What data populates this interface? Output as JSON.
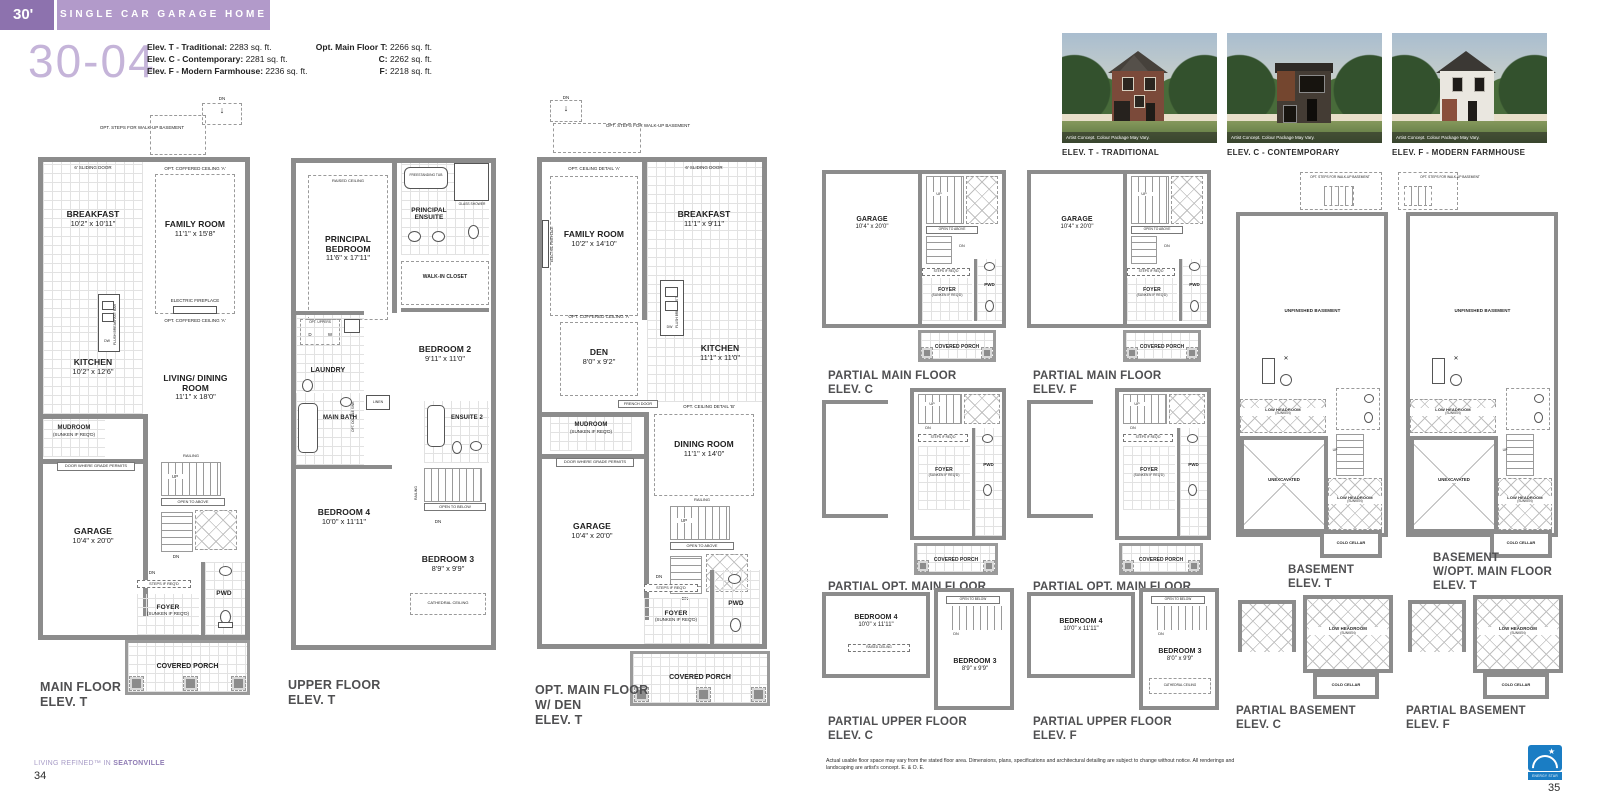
{
  "header": {
    "width_tag": "30'",
    "band": "SINGLE CAR GARAGE HOME",
    "model": "30-04",
    "specs": [
      {
        "label": "Elev. T - Traditional:",
        "value": " 2283 sq. ft."
      },
      {
        "label": "Elev. C - Contemporary:",
        "value": " 2281 sq. ft."
      },
      {
        "label": "Elev. F - Modern Farmhouse:",
        "value": " 2236 sq. ft."
      }
    ],
    "opt_specs": [
      {
        "label": "Opt. Main Floor T:",
        "value": " 2266 sq. ft."
      },
      {
        "label": "C:",
        "value": " 2262 sq. ft."
      },
      {
        "label": "F:",
        "value": " 2218 sq. ft."
      }
    ]
  },
  "elevations": {
    "caption": "Artist Concept. Colour Package May Vary.",
    "t": "ELEV. T - TRADITIONAL",
    "c": "ELEV. C - CONTEMPORARY",
    "f": "ELEV. F - MODERN FARMHOUSE"
  },
  "plan_main": {
    "title_l1": "MAIN FLOOR",
    "title_l2": "ELEV. T",
    "rooms": {
      "breakfast": {
        "name": "BREAKFAST",
        "dims": "10'2\" x 10'11\""
      },
      "family": {
        "name": "FAMILY ROOM",
        "dims": "11'1\" x 15'8\""
      },
      "kitchen": {
        "name": "KITCHEN",
        "dims": "10'2\" x 12'6\""
      },
      "mudroom": {
        "name": "MUDROOM",
        "sub": "(SUNKEN IF REQ'D)"
      },
      "living": {
        "name": "LIVING/ DINING ROOM",
        "dims": "11'1\" x 18'0\""
      },
      "garage": {
        "name": "GARAGE",
        "dims": "10'4\" x 20'0\""
      },
      "foyer": {
        "name": "FOYER",
        "sub": "(SUNKEN IF REQ'D)"
      },
      "pwd": {
        "name": "PWD"
      },
      "porch": {
        "name": "COVERED PORCH"
      }
    },
    "notes": {
      "dn": "DN",
      "arrow_down": "↓",
      "walkup": "OPT. STEPS FOR WALK-UP BASEMENT",
      "sliding": "6' SLIDING DOOR",
      "coffered1": "OPT. COFFERED CEILING 'A'",
      "fireplace": "ELECTRIC FIREPLACE",
      "coffered2": "OPT. COFFERED CEILING 'A'",
      "bkfstbar": "FLUSH BREAKFAST BAR",
      "dw": "DW",
      "gradedoor": "DOOR WHERE GRADE PERMITS",
      "railing": "RAILING",
      "up": "UP",
      "ota": "OPEN TO ABOVE",
      "dn2": "DN",
      "steps": "STEPS IF REQ'D"
    }
  },
  "plan_upper": {
    "title_l1": "UPPER FLOOR",
    "title_l2": "ELEV. T",
    "rooms": {
      "principal": {
        "name": "PRINCIPAL BEDROOM",
        "dims": "11'6\" x 17'11\""
      },
      "ensuite": {
        "name": "PRINCIPAL ENSUITE"
      },
      "wic": {
        "name": "WALK-IN CLOSET"
      },
      "bed2": {
        "name": "BEDROOM 2",
        "dims": "9'11\" x 11'0\""
      },
      "laundry": {
        "name": "LAUNDRY"
      },
      "mainbath": {
        "name": "MAIN BATH"
      },
      "bed4": {
        "name": "BEDROOM 4",
        "dims": "10'0\" x 11'11\""
      },
      "ensuite2": {
        "name": "ENSUITE 2"
      },
      "bed3": {
        "name": "BEDROOM 3",
        "dims": "8'9\" x 9'9\""
      }
    },
    "notes": {
      "raised": "RAISED CEILING",
      "tub": "FREESTANDING TUB",
      "shower": "GLASS SHOWER",
      "uppers": "OPT. UPPERS",
      "d": "D",
      "w": "W",
      "dblsink": "OPT. DOUBLE SINK",
      "linen": "LINEN",
      "railing": "RAILING",
      "otb": "OPEN TO BELOW",
      "dn": "DN",
      "cathedral": "CATHEDRAL CEILING"
    }
  },
  "plan_opt": {
    "title_l1": "OPT. MAIN FLOOR",
    "title_l2": "W/ DEN",
    "title_l3": "ELEV. T",
    "rooms": {
      "family": {
        "name": "FAMILY ROOM",
        "dims": "10'2\" x 14'10\""
      },
      "breakfast": {
        "name": "BREAKFAST",
        "dims": "11'1\" x 9'11\""
      },
      "kitchen": {
        "name": "KITCHEN",
        "dims": "11'1\" x 11'0\""
      },
      "den": {
        "name": "DEN",
        "dims": "8'0\" x 9'2\""
      },
      "mudroom": {
        "name": "MUDROOM",
        "sub": "(SUNKEN IF REQ'D)"
      },
      "dining": {
        "name": "DINING ROOM",
        "dims": "11'1\" x 14'0\""
      },
      "garage": {
        "name": "GARAGE",
        "dims": "10'4\" x 20'0\""
      },
      "foyer": {
        "name": "FOYER",
        "sub": "(SUNKEN IF REQ'D)"
      },
      "pwd": {
        "name": "PWD"
      },
      "porch": {
        "name": "COVERED PORCH"
      }
    },
    "notes": {
      "dn": "DN",
      "arrow_down": "↓",
      "walkup": "OPT. STEPS FOR WALK-UP BASEMENT",
      "ceila": "OPT. CEILING DETAIL 'A'",
      "sliding": "6' SLIDING DOOR",
      "fireplace": "ELECTRIC FIREPLACE",
      "bkfstbar": "FLUSH BREAKFAST BAR",
      "dw": "DW",
      "coffered": "OPT. COFFERED CEILING 'A'",
      "french": "FRENCH DOOR",
      "ceilb": "OPT. CEILING DETAIL 'B'",
      "gradedoor": "DOOR WHERE GRADE PERMITS",
      "railing": "RAILING",
      "up": "UP",
      "ota": "OPEN TO ABOVE",
      "dn2": "DN",
      "steps": "STEPS IF REQ'D"
    }
  },
  "partial_main_c": {
    "title_l1": "PARTIAL MAIN FLOOR",
    "title_l2": "ELEV. C",
    "garage": {
      "name": "GARAGE",
      "dims": "10'4\" x 20'0\""
    },
    "foyer": {
      "name": "FOYER",
      "sub": "(SUNKEN IF REQ'D)"
    },
    "pwd": "PWD",
    "porch": "COVERED PORCH",
    "up": "UP",
    "ota": "OPEN TO ABOVE",
    "dn": "DN",
    "steps": "STEPS IF REQ'D"
  },
  "partial_main_f": {
    "title_l1": "PARTIAL MAIN FLOOR",
    "title_l2": "ELEV. F",
    "garage": {
      "name": "GARAGE",
      "dims": "10'4\" x 20'0\""
    },
    "foyer": {
      "name": "FOYER",
      "sub": "(SUNKEN IF REQ'D)"
    },
    "pwd": "PWD",
    "porch": "COVERED PORCH",
    "up": "UP",
    "ota": "OPEN TO ABOVE",
    "dn": "DN",
    "steps": "STEPS IF REQ'D"
  },
  "partial_opt_c": {
    "title_l1": "PARTIAL OPT. MAIN FLOOR",
    "title_l2": "ELEV. C",
    "foyer": {
      "name": "FOYER",
      "sub": "(SUNKEN IF REQ'D)"
    },
    "pwd": "PWD",
    "porch": "COVERED PORCH",
    "up": "UP",
    "dn": "DN",
    "steps": "STEPS IF REQ'D"
  },
  "partial_opt_f": {
    "title_l1": "PARTIAL OPT. MAIN FLOOR",
    "title_l2": "ELEV. F",
    "foyer": {
      "name": "FOYER",
      "sub": "(SUNKEN IF REQ'D)"
    },
    "pwd": "PWD",
    "porch": "COVERED PORCH",
    "up": "UP",
    "dn": "DN",
    "steps": "STEPS IF REQ'D"
  },
  "partial_upper_c": {
    "title_l1": "PARTIAL UPPER FLOOR",
    "title_l2": "ELEV. C",
    "bed4": {
      "name": "BEDROOM 4",
      "dims": "10'0\" x 11'11\""
    },
    "bed3": {
      "name": "BEDROOM 3",
      "dims": "8'9\" x 9'9\""
    },
    "raised": "RAISED CEILING",
    "otb": "OPEN TO BELOW",
    "dn": "DN"
  },
  "partial_upper_f": {
    "title_l1": "PARTIAL UPPER FLOOR",
    "title_l2": "ELEV. F",
    "bed4": {
      "name": "BEDROOM 4",
      "dims": "10'0\" x 11'11\""
    },
    "bed3": {
      "name": "BEDROOM 3",
      "dims": "8'0\" x 9'9\""
    },
    "cathedral": "CATHEDRAL CEILING",
    "otb": "OPEN TO BELOW",
    "dn": "DN"
  },
  "basement_t": {
    "title_l1": "BASEMENT",
    "title_l2": "ELEV. T",
    "walkup": "OPT. STEPS FOR WALK-UP BASEMENT",
    "unfinished": "UNFINISHED BASEMENT",
    "lowhead1": "LOW HEADROOM",
    "lowhead1_sub": "(SUNKEN)",
    "unexcavated": "UNEXCAVATED",
    "lowhead2": "LOW HEADROOM",
    "lowhead2_sub": "(SUNKEN)",
    "cold": "COLD CELLAR",
    "up": "UP"
  },
  "basement_opt": {
    "title_l1": "BASEMENT",
    "title_l2": "W/OPT. MAIN FLOOR",
    "title_l3": "ELEV.  T",
    "walkup": "OPT. STEPS FOR WALK-UP BASEMENT",
    "unfinished": "UNFINISHED BASEMENT",
    "lowhead1": "LOW HEADROOM",
    "lowhead1_sub": "(SUNKEN)",
    "unexcavated": "UNEXCAVATED",
    "lowhead2": "LOW HEADROOM",
    "lowhead2_sub": "(SUNKEN)",
    "cold": "COLD CELLAR",
    "up": "UP"
  },
  "partial_bsmt_c": {
    "title_l1": "PARTIAL BASEMENT",
    "title_l2": "ELEV.  C",
    "lowhead": "LOW HEADROOM",
    "lowhead_sub": "(SUNKEN)",
    "cold": "COLD CELLAR"
  },
  "partial_bsmt_f": {
    "title_l1": "PARTIAL BASEMENT",
    "title_l2": "ELEV. F",
    "lowhead": "LOW HEADROOM",
    "lowhead_sub": "(SUNKEN)",
    "cold": "COLD CELLAR"
  },
  "footer": {
    "tagline_pre": "LIVING REFINED™ IN ",
    "tagline_bold": "SEATONVILLE",
    "page_left": "34",
    "disclaimer": "Actual usable floor space may vary from the stated floor area. Dimensions, plans, specifications and architectural detailing are subject to change without notice. All renderings and landscaping are artist's concept. E. & O. E.",
    "page_right": "35",
    "energy_label": "ENERGY STAR"
  }
}
